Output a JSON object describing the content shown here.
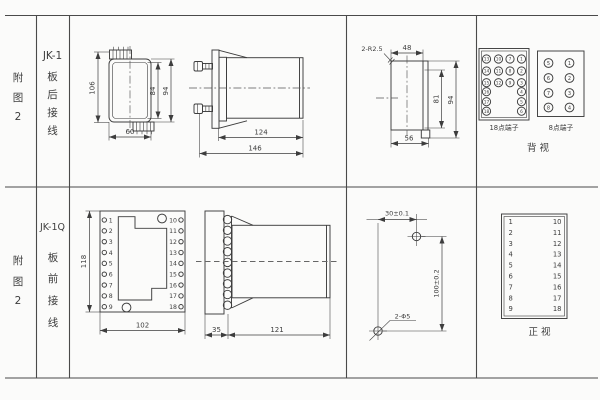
{
  "colors": {
    "paper": "#fbfbfa",
    "ink": "#3d3d3d"
  },
  "row1": {
    "fig_no": [
      "附",
      "图",
      "2"
    ],
    "model": "JK-1",
    "wiring": [
      "板",
      "后",
      "接",
      "线"
    ],
    "front_view": {
      "overall_height": "106",
      "inner_height": "84",
      "outer_height": "94",
      "width": "60"
    },
    "side_view": {
      "body_length": "124",
      "total_length": "146"
    },
    "cutout": {
      "corner_radius": "2-R2.5",
      "top_width": "48",
      "inner_height": "81",
      "outer_height": "94",
      "bottom_width": "56"
    },
    "rear_view": {
      "label": "背 视",
      "t18": {
        "label": "18点端子",
        "grid_rows": [
          [
            "13",
            "10",
            "7",
            "1"
          ],
          [
            "14",
            "11",
            "8",
            "2"
          ],
          [
            "15",
            "12",
            "9",
            "3"
          ]
        ],
        "pair_rows": [
          [
            "16",
            "4"
          ],
          [
            "17",
            "5"
          ],
          [
            "18",
            "6"
          ]
        ]
      },
      "t8": {
        "label": "8点端子",
        "rows": [
          [
            "5",
            "1"
          ],
          [
            "6",
            "2"
          ],
          [
            "7",
            "3"
          ],
          [
            "8",
            "4"
          ]
        ]
      }
    }
  },
  "row2": {
    "fig_no": [
      "附",
      "图",
      "2"
    ],
    "model": "JK-1Q",
    "wiring": [
      "板",
      "前",
      "接",
      "线"
    ],
    "front_view": {
      "height": "118",
      "width": "102",
      "left_terminals": [
        "1",
        "2",
        "3",
        "4",
        "5",
        "6",
        "7",
        "8",
        "9"
      ],
      "right_terminals": [
        "10",
        "11",
        "12",
        "13",
        "14",
        "15",
        "16",
        "17",
        "18"
      ]
    },
    "side_view": {
      "plate_depth": "35",
      "body_length": "121"
    },
    "drill_plan": {
      "h_spacing": "30±0.1",
      "v_spacing": "100±0.2",
      "holes": "2-Φ5"
    },
    "terminal_table": {
      "label": "正 视",
      "left": [
        "1",
        "2",
        "3",
        "4",
        "5",
        "6",
        "7",
        "8",
        "9"
      ],
      "right": [
        "10",
        "11",
        "12",
        "13",
        "14",
        "15",
        "16",
        "17",
        "18"
      ]
    }
  }
}
